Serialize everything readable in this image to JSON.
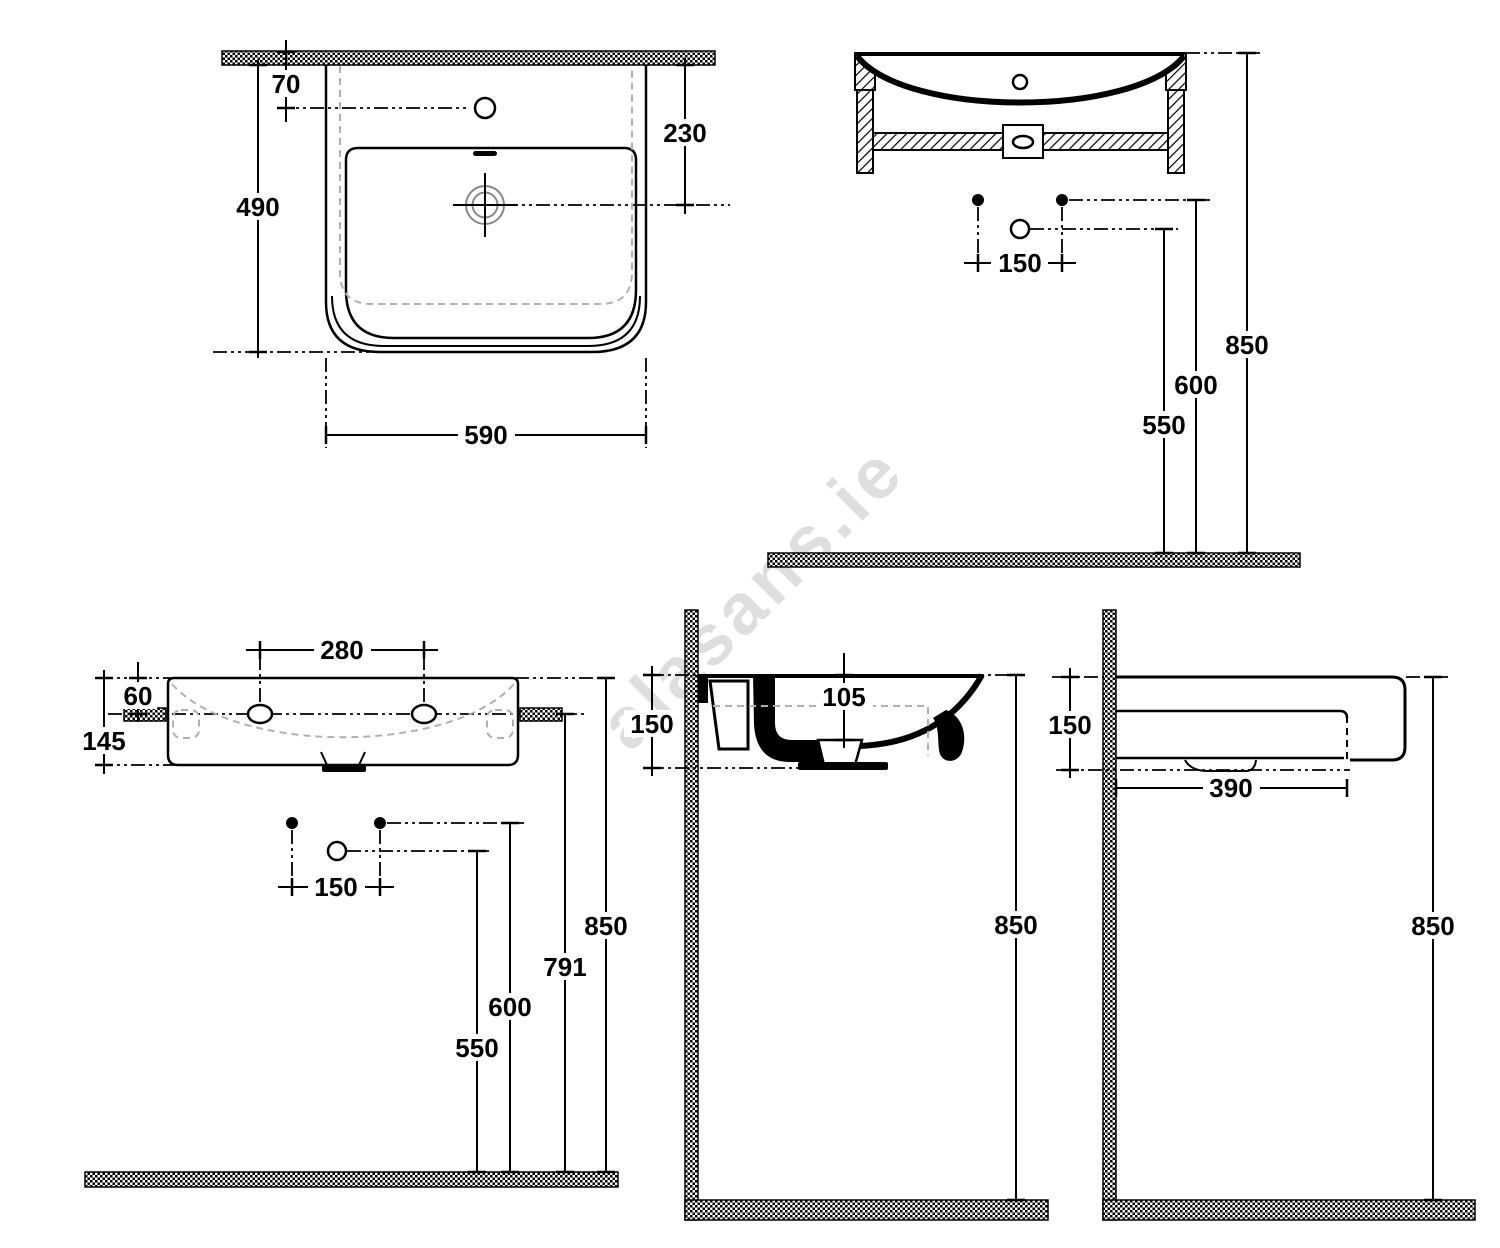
{
  "watermark": "alasans.ie",
  "views": {
    "plan": {
      "tap_offset": "70",
      "drain_from_edge": "230",
      "depth": "490",
      "width": "590"
    },
    "front_section": {
      "bolt_spacing": "150",
      "drain_height": "550",
      "bolt_height": "600",
      "total_height": "850"
    },
    "front": {
      "hole_spacing": "280",
      "hole_drop": "60",
      "body_height": "145",
      "bolt_spacing": "150",
      "drain_height": "550",
      "bolt_height": "600",
      "fixing_height": "791",
      "total_height": "850"
    },
    "side_section": {
      "drain_drop": "105",
      "body_height": "150",
      "total_height": "850"
    },
    "side": {
      "body_height": "150",
      "underside_depth": "390",
      "total_height": "850"
    }
  }
}
